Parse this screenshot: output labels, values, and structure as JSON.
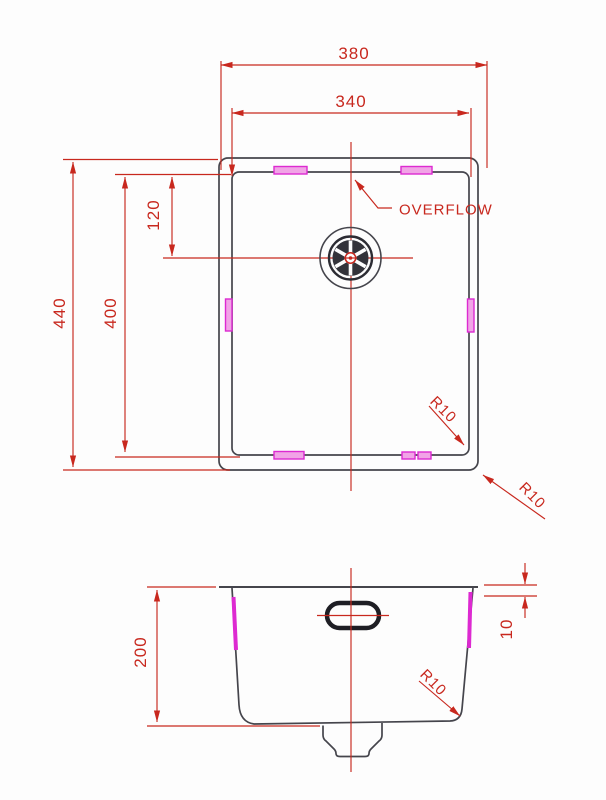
{
  "drawing": {
    "type": "sink technical drawing, plan and section views",
    "colors": {
      "dimension_red": "#c8281e",
      "hardware_magenta": "#dd2ad1",
      "outline_gray": "#45454c",
      "background": "#fdfdfd"
    },
    "plan": {
      "outer_width": "380",
      "inner_width": "340",
      "outer_length": "440",
      "inner_length": "400",
      "drain_offset": "120",
      "overflow_label": "OVERFLOW",
      "radius_inner": "R10",
      "radius_outer": "R10"
    },
    "section": {
      "depth": "200",
      "rim_step": "10",
      "radius": "R10"
    }
  }
}
